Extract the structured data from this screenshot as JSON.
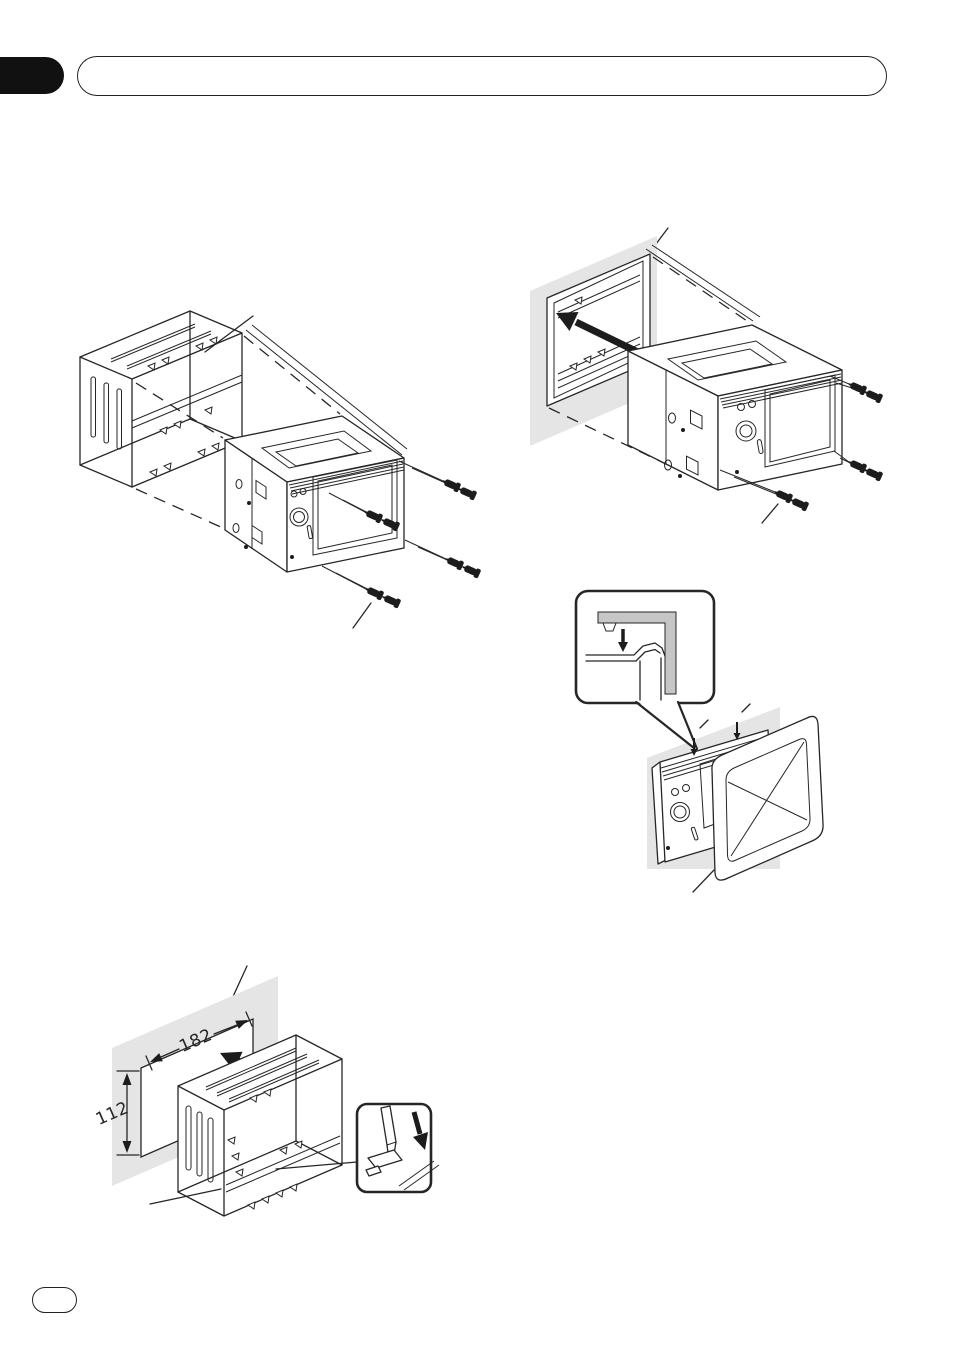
{
  "page": {
    "background": "#ffffff",
    "line_color": "#262626",
    "panel_gray": "#e5e5e5",
    "tab_color": "#111111"
  },
  "header": {
    "section_tab": "black-index-tab",
    "title_bar": "empty-rounded-title-bar"
  },
  "footer": {
    "page_number_pill": "empty-page-number-pill"
  },
  "figures": {
    "fig1": {
      "name": "attach-mounting-sleeve-to-unit-exploded-view"
    },
    "fig2": {
      "name": "slide-unit-into-dashboard-opening"
    },
    "fig3": {
      "name": "attach-trim-frame-with-clip-detail"
    },
    "fig4": {
      "name": "install-mounting-sleeve-into-dashboard",
      "dash_opening": {
        "width": "182",
        "height": "112"
      }
    }
  },
  "icons": {
    "insertion_arrow": "bold-arrow-up-left",
    "press_down_arrow": "bold-arrow-down",
    "screwdriver": "flat-blade-screwdriver",
    "screw": "mounting-screw",
    "bend_tab": "metal-tab"
  }
}
